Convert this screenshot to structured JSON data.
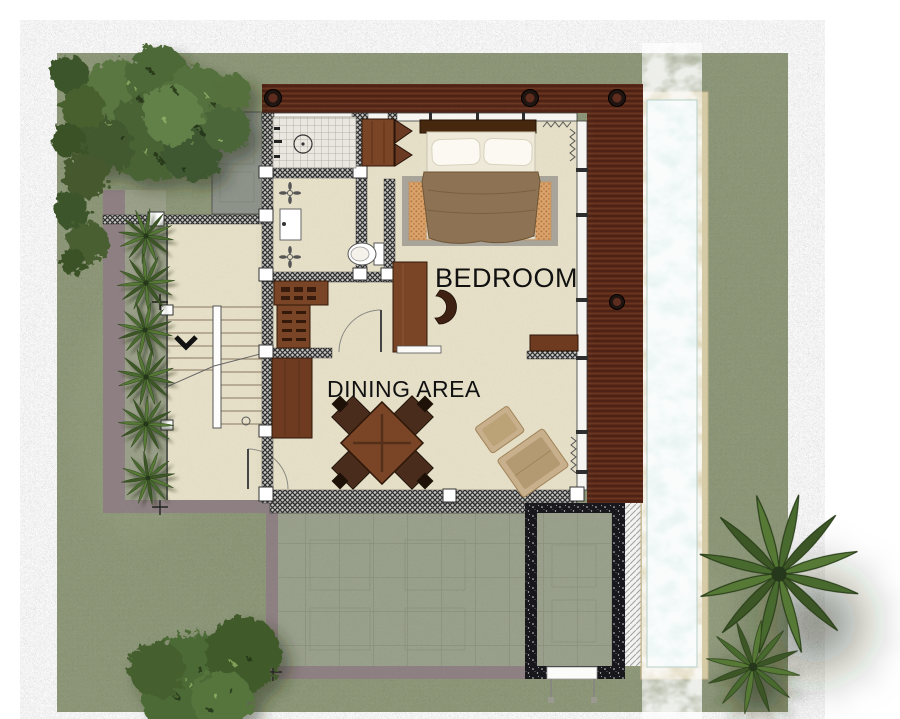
{
  "labels": {
    "bedroom": "BEDROOM",
    "dining_area": "DINING AREA"
  },
  "colors": {
    "grass": "#8c9775",
    "floor": "#e8e1c9",
    "pool_water": "#dff0ee",
    "pool_border": "#d8cda6",
    "deck_wood": "#5c2b1a",
    "terrace_paving": "#99a08b",
    "timber_furniture": "#7a4526",
    "dark_stone": "#17171c",
    "boundary_taupe": "#8e8082",
    "tree_green": "#55703c",
    "label_text": "#111111"
  }
}
